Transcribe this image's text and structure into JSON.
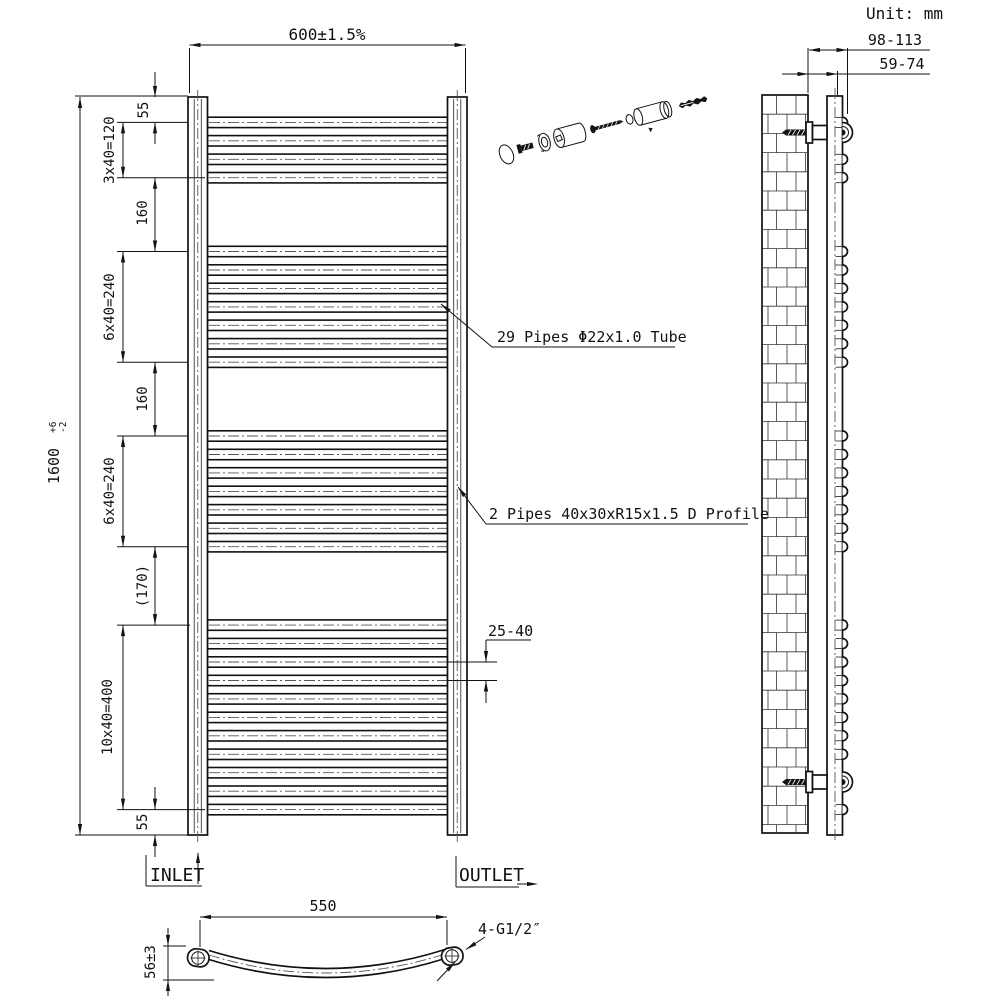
{
  "title": {
    "unit_label": "Unit: mm"
  },
  "front_view": {
    "width_dim": "600±1.5%",
    "height_dim": {
      "value": "1600",
      "tol_plus": "+6",
      "tol_minus": "-2"
    },
    "left_chain": [
      "55",
      "3x40=120",
      "160",
      "6x40=240",
      "160",
      "6x40=240",
      "(170)",
      "10x40=400",
      "55"
    ],
    "pipe_gap_dim": "25-40",
    "labels": {
      "pipes": "29 Pipes Φ22x1.0 Tube",
      "profile": "2 Pipes 40x30xR15x1.5 D Profile"
    },
    "inlet_label": "INLET",
    "outlet_label": "OUTLET",
    "pipes": {
      "tube_count": 29,
      "pitch_mm": 40,
      "total_mm": 1600,
      "groups": [
        {
          "start_mm": 55,
          "count": 4
        },
        {
          "start_mm": 335,
          "count": 7
        },
        {
          "start_mm": 735,
          "count": 7
        },
        {
          "start_mm": 1145,
          "count": 11
        }
      ]
    }
  },
  "side_view": {
    "wall_to_front_dim": "98-113",
    "wall_to_back_dim": "59-74"
  },
  "bottom_view": {
    "width_dim": "550",
    "thread_label": "4-G1/2″",
    "depth_dim": "56±3"
  },
  "colors": {
    "line": "#111111",
    "centerline": "#555555",
    "background": "#ffffff"
  }
}
